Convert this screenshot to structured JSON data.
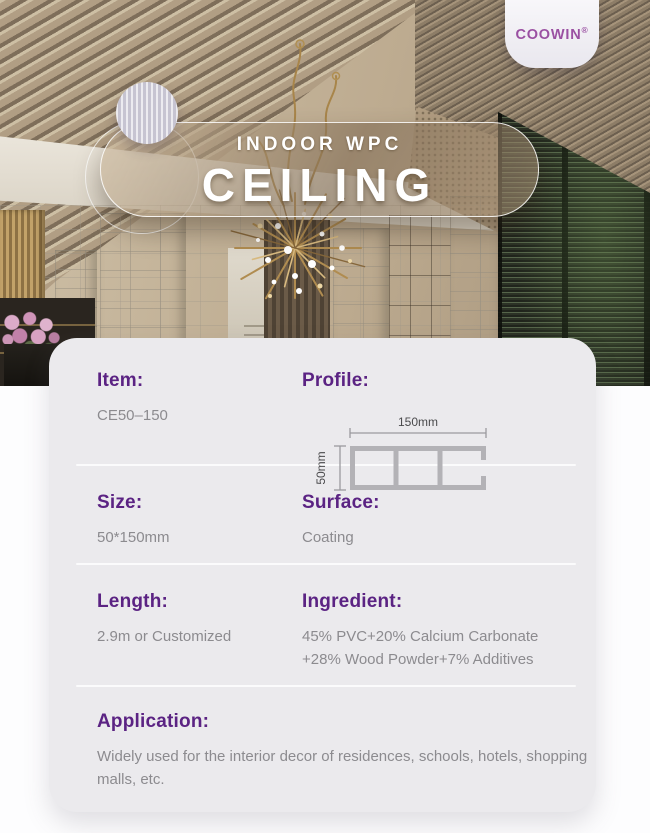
{
  "brand": {
    "name": "COOWIN",
    "registered": "®"
  },
  "hero": {
    "category": "INDOOR WPC",
    "title": "CEILING"
  },
  "card": {
    "item": {
      "label": "Item:",
      "value": "CE50–150"
    },
    "profile": {
      "label": "Profile:",
      "width_dim": "150mm",
      "height_dim": "50mm"
    },
    "size": {
      "label": "Size:",
      "value": "50*150mm"
    },
    "surface": {
      "label": "Surface:",
      "value": "Coating"
    },
    "length": {
      "label": "Length:",
      "value": "2.9m or Customized"
    },
    "ingredient": {
      "label": "Ingredient:",
      "value": "45% PVC+20% Calcium Carbonate +28% Wood Powder+7% Additives"
    },
    "application": {
      "label": "Application:",
      "value": "Widely used for the interior decor of residences, schools, hotels, shopping malls, etc."
    }
  },
  "colors": {
    "accent_purple": "#5b2383",
    "logo_purple": "#9a50a2",
    "value_gray": "#8c8b8f",
    "card_background": "#ebeaed",
    "divider": "#fbfbfc",
    "banner_text": "#ffffff"
  }
}
